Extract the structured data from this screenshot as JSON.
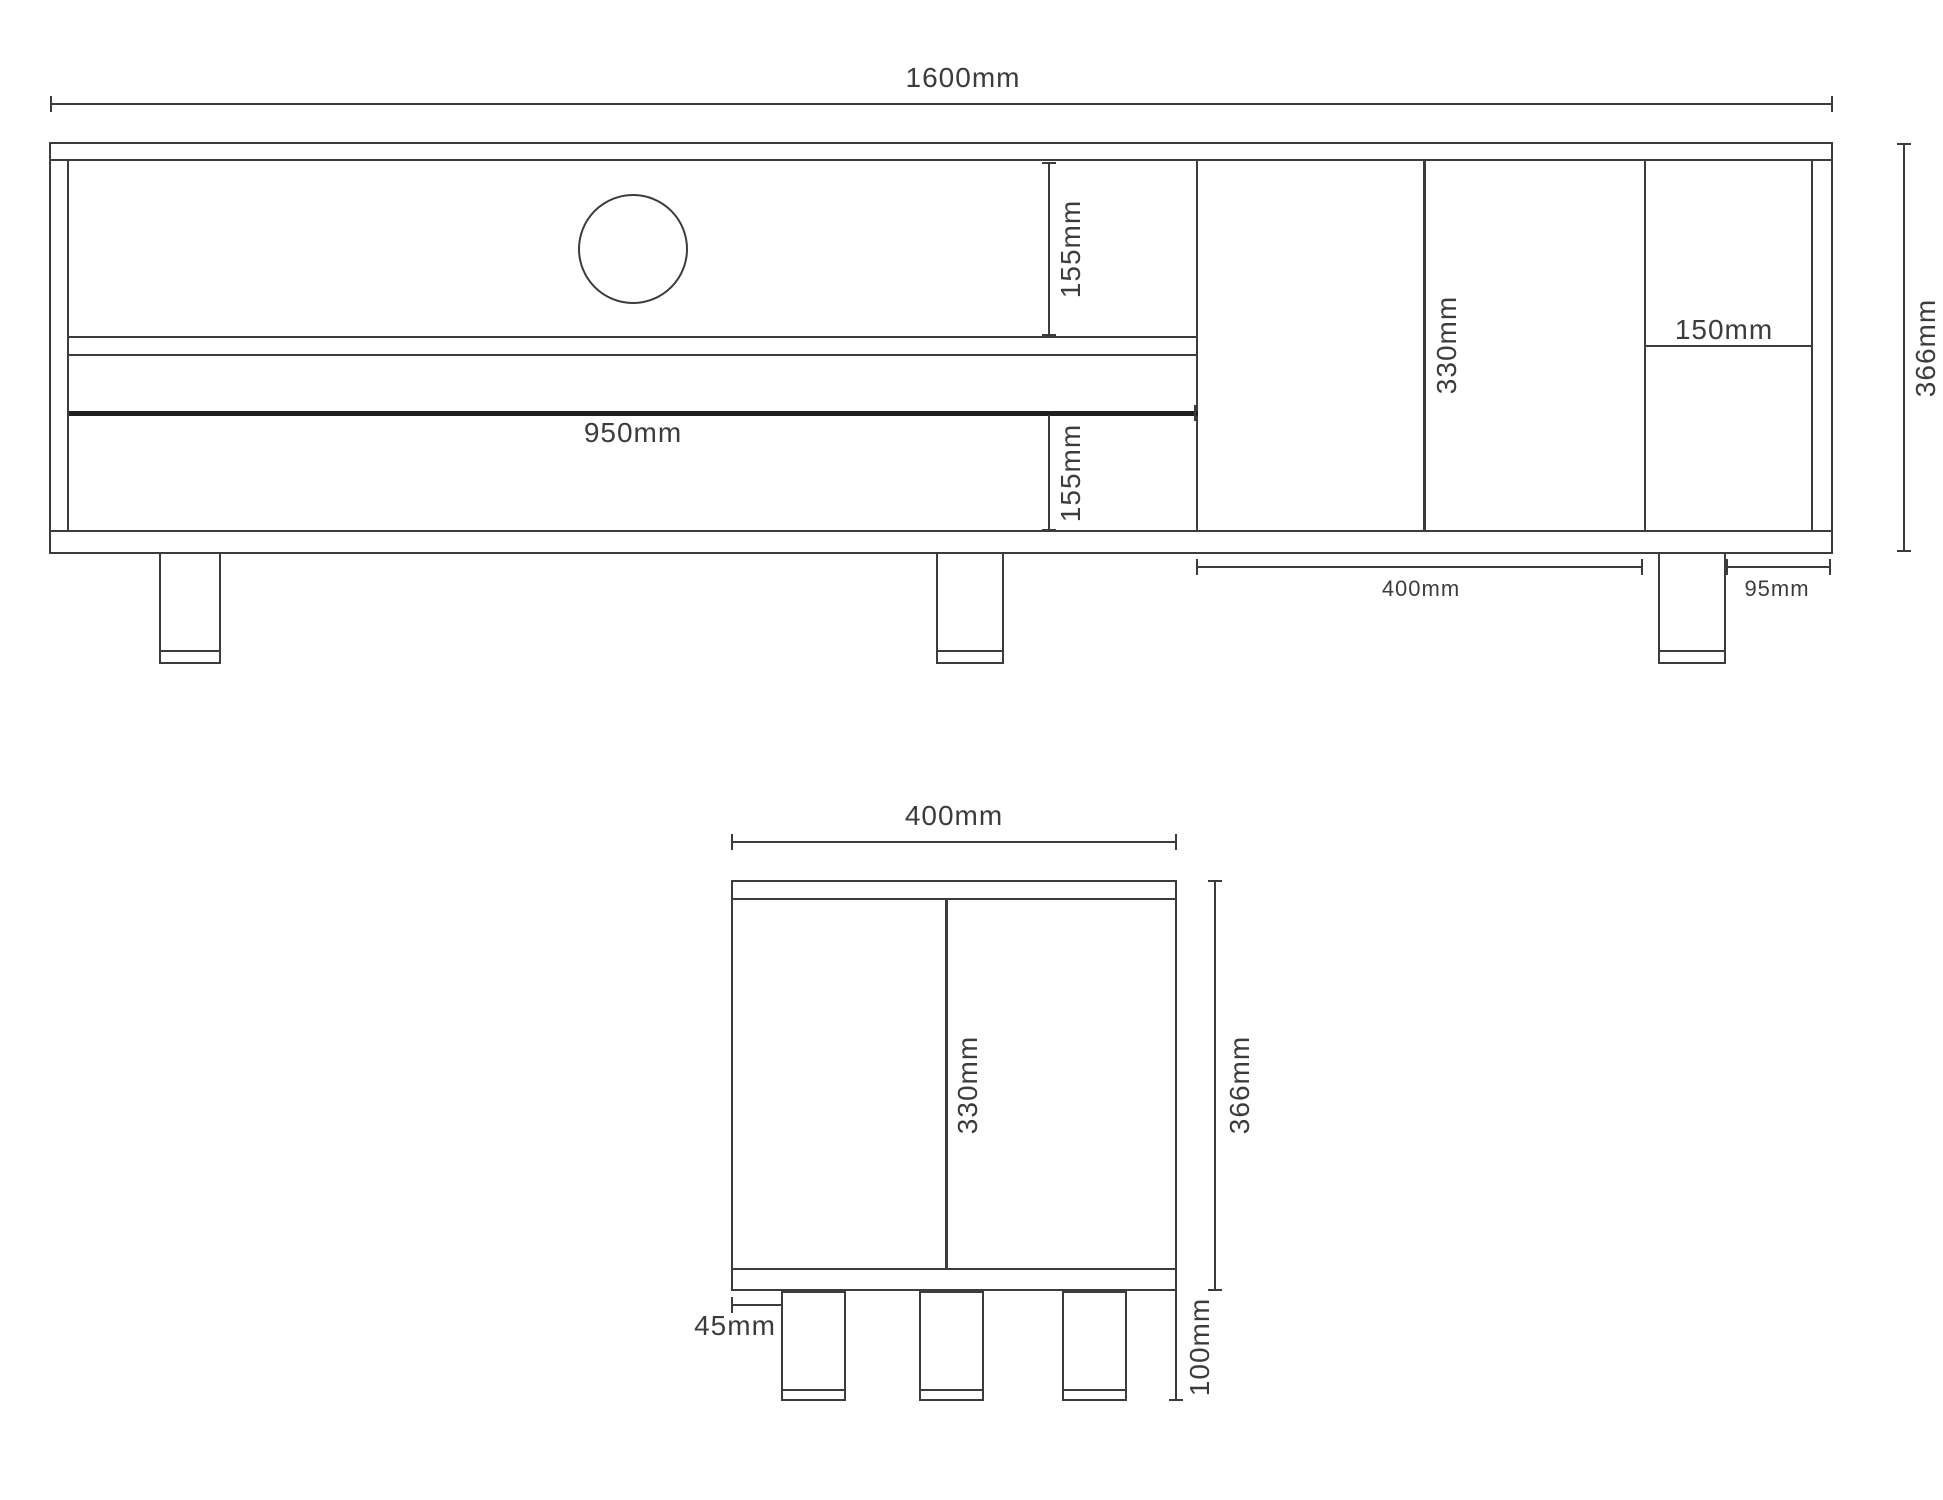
{
  "front": {
    "overall_width": "1600mm",
    "top_shelf_height": "155mm",
    "drawer_height": "155mm",
    "drawer_width": "950mm",
    "door_height": "330mm",
    "right_shelf_width": "150mm",
    "overall_height": "366mm",
    "door_section_width": "400mm",
    "leg_to_edge": "95mm"
  },
  "side": {
    "depth": "400mm",
    "interior_height": "330mm",
    "overall_height": "366mm",
    "leg_height": "100mm",
    "leg_inset": "45mm"
  },
  "colors": {
    "line": "#3c3c3c",
    "thick_line": "#1f1f1f",
    "background": "#ffffff"
  }
}
